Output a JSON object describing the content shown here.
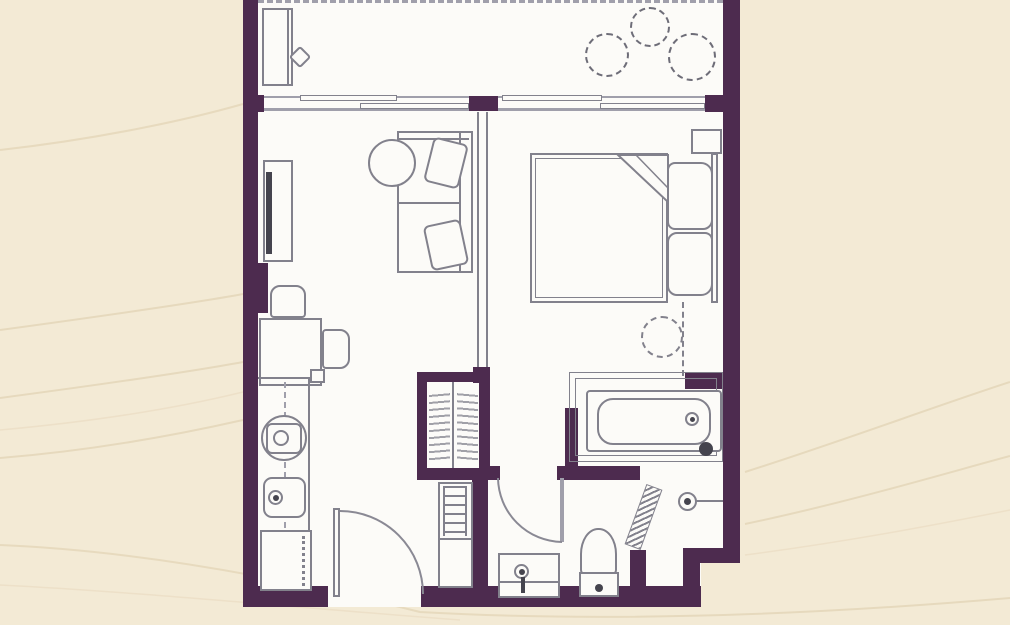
{
  "scene": {
    "type": "floor-plan",
    "view": "top-down architectural drawing",
    "visible_text": ""
  },
  "colors": {
    "background": "#f3ead5",
    "wall": "#4d2b4f",
    "floor": "#fcfbf8",
    "line": "#82818c",
    "line_light": "#a09fab",
    "line_dark": "#45444e",
    "texture": "#e5d8bb"
  },
  "rooms": [
    {
      "name": "balcony"
    },
    {
      "name": "living-room"
    },
    {
      "name": "kitchen"
    },
    {
      "name": "entry"
    },
    {
      "name": "hallway"
    },
    {
      "name": "bedroom"
    },
    {
      "name": "bathroom"
    }
  ],
  "symbols": {
    "balcony": [
      "balcony-railing",
      "balcony-table",
      "balcony-chair",
      "plant-pot",
      "plant-pot",
      "plant-pot"
    ],
    "living_room": [
      "tv-unit",
      "tv-screen",
      "sofa",
      "sofa-cushion",
      "sofa-cushion",
      "round-coffee-table",
      "dining-table",
      "dining-chair",
      "dining-chair"
    ],
    "kitchen": [
      "kitchen-counter",
      "washing-machine",
      "kitchen-sink",
      "refrigerator"
    ],
    "entry": [
      "entry-door",
      "utility-cabinet",
      "ladder-shelf"
    ],
    "hallway": [
      "wardrobe",
      "wardrobe-clothes-rail"
    ],
    "bedroom": [
      "double-bed",
      "pillow",
      "pillow",
      "folded-blanket",
      "headboard",
      "nightstand",
      "rug-dashed-circle"
    ],
    "bathroom": [
      "bathroom-door",
      "bathtub",
      "bath-faucet",
      "toilet",
      "washbasin",
      "towel-radiator",
      "shower-head"
    ]
  }
}
